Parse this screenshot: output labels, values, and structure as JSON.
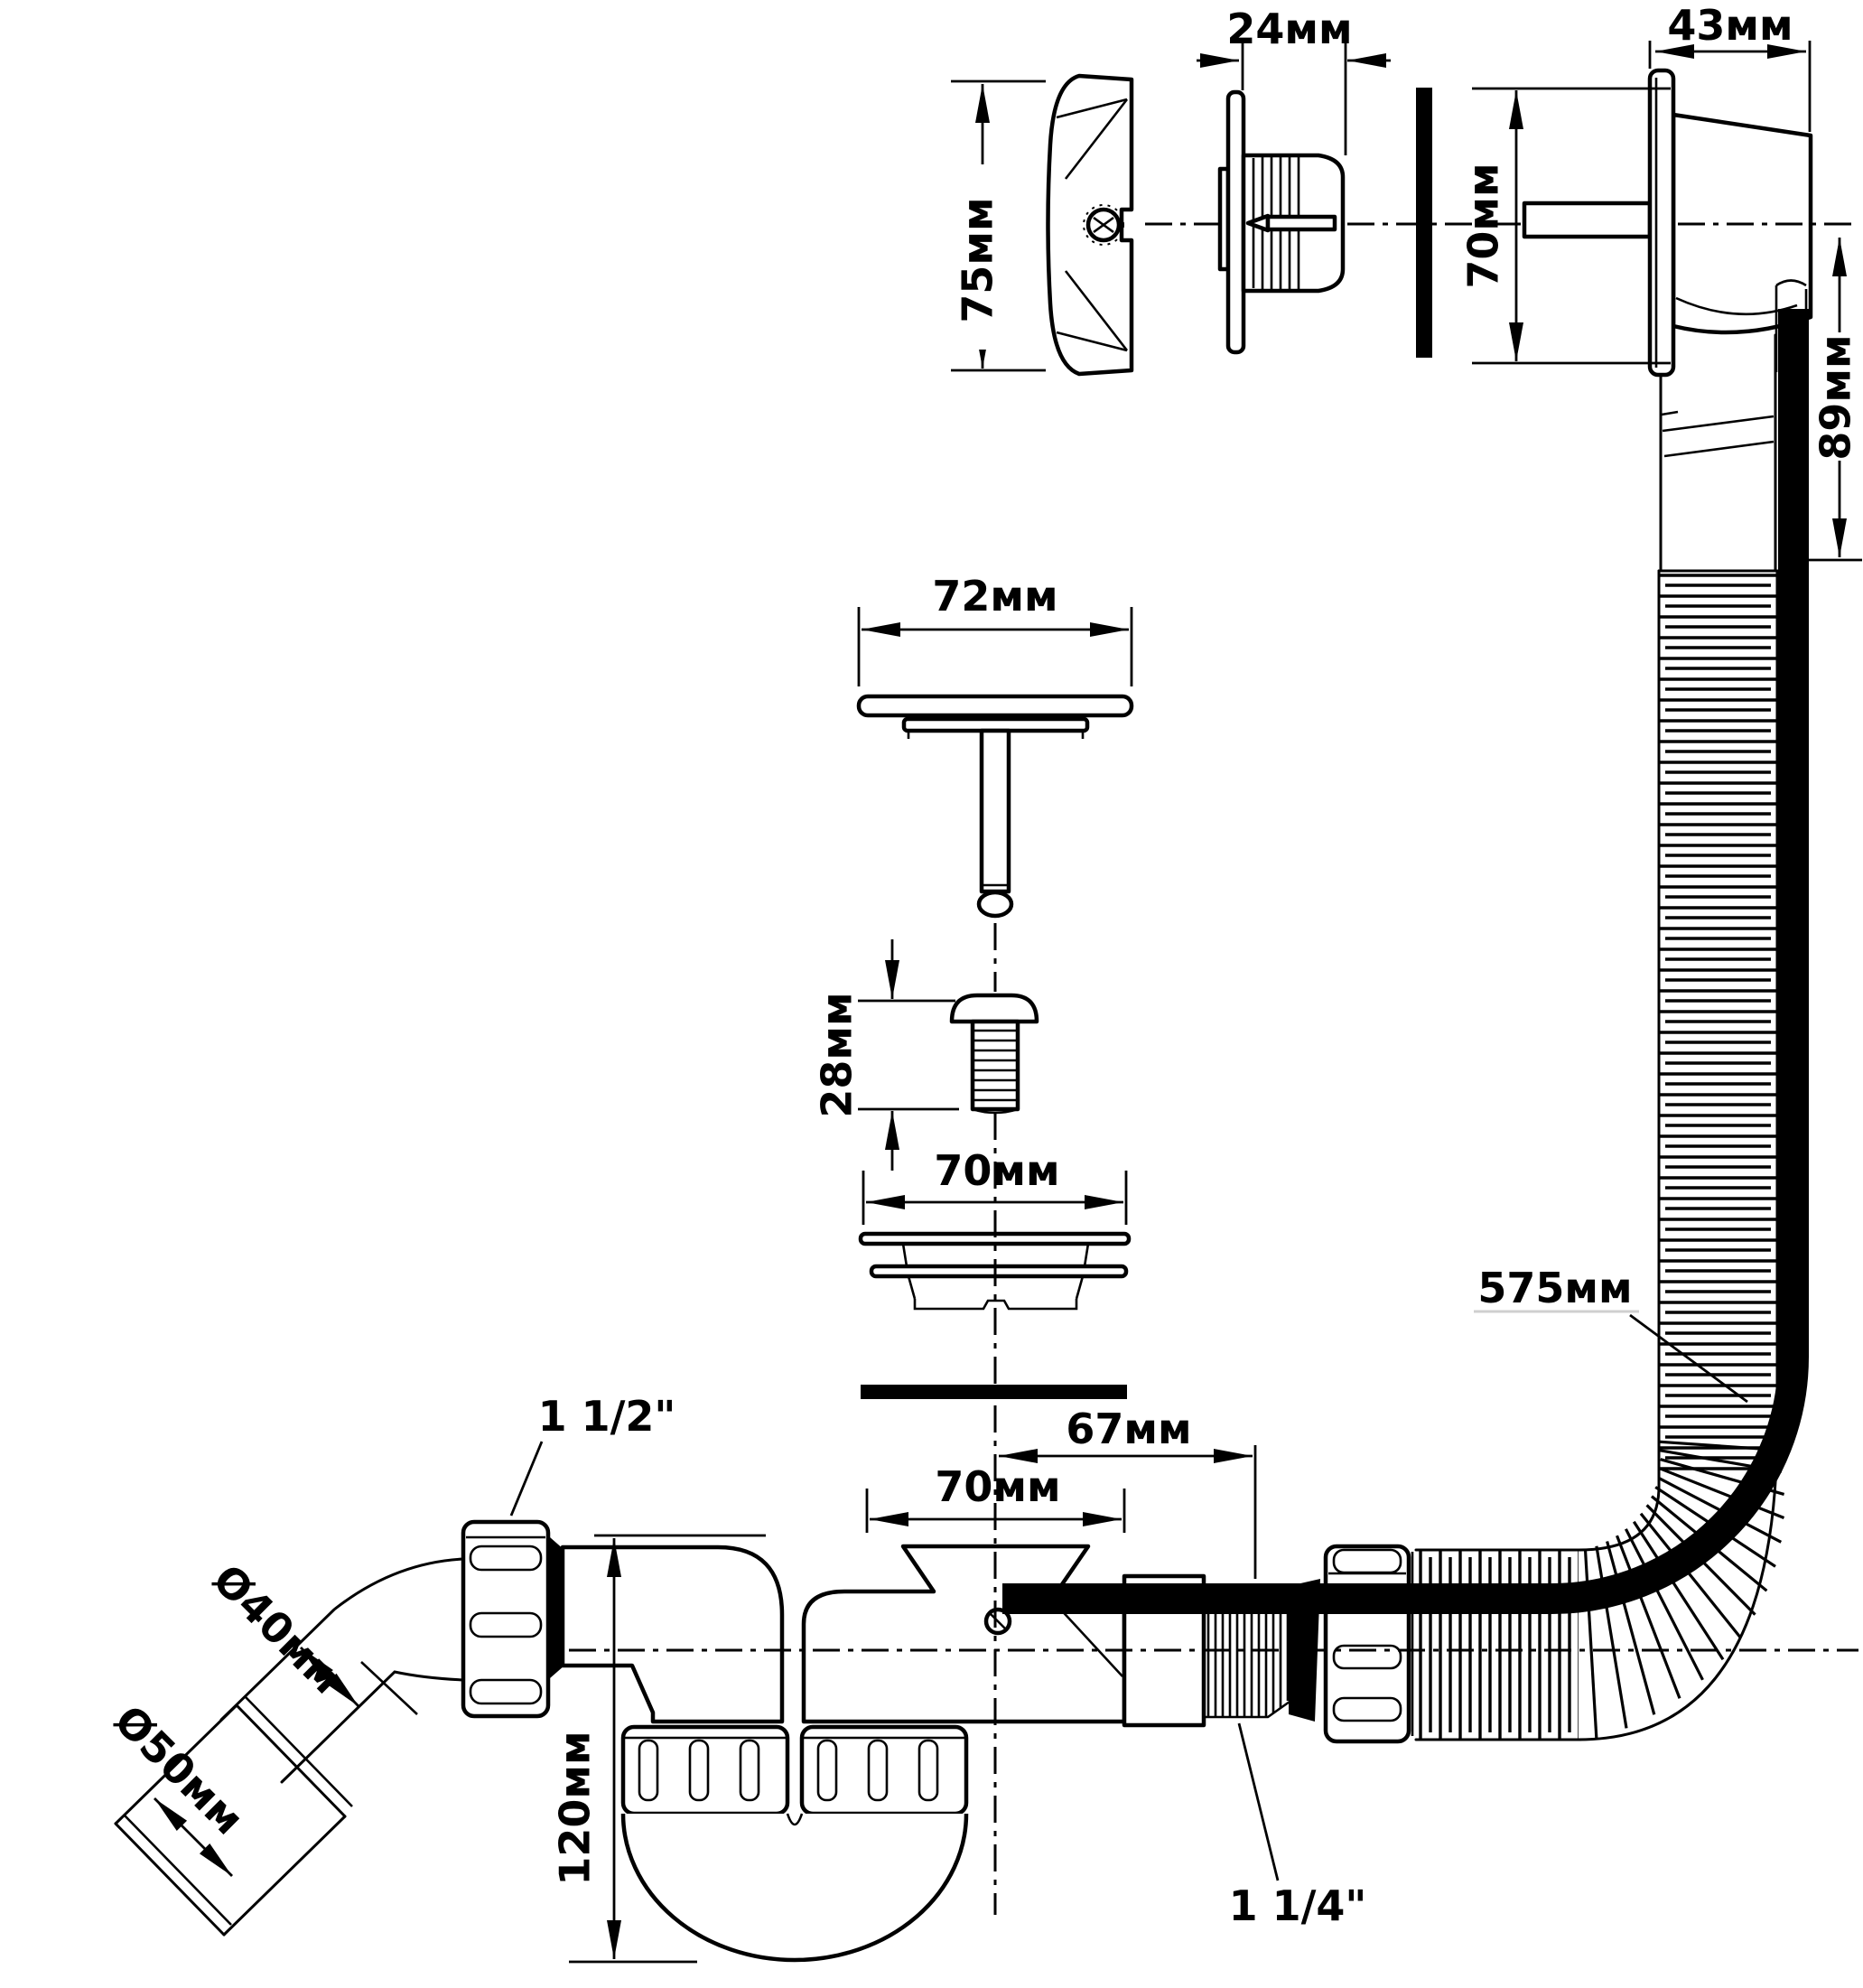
{
  "drawing": {
    "type": "technical-diagram",
    "subject": "bath waste and overflow siphon kit with dimensions",
    "colors": {
      "line": "#000000",
      "background": "#ffffff"
    },
    "dimensions": {
      "overflow_cover_height": "75мм",
      "overflow_flange_depth": "24мм",
      "overflow_body_depth": "43мм",
      "overflow_body_height": "70мм",
      "overflow_outlet_drop": "89мм",
      "plug_cap_diameter": "72мм",
      "plug_screw_length": "28мм",
      "strainer_diameter": "70мм",
      "trap_inlet_diameter": "70мм",
      "overflow_port_offset": "67мм",
      "overflow_hose_length": "575мм",
      "trap_depth": "120мм",
      "outlet_pipe_diameter": "Ø40мм",
      "outlet_adapter_diameter": "Ø50мм",
      "outlet_nut_thread": "1 1/2\"",
      "overflow_nut_thread": "1 1/4\""
    }
  }
}
